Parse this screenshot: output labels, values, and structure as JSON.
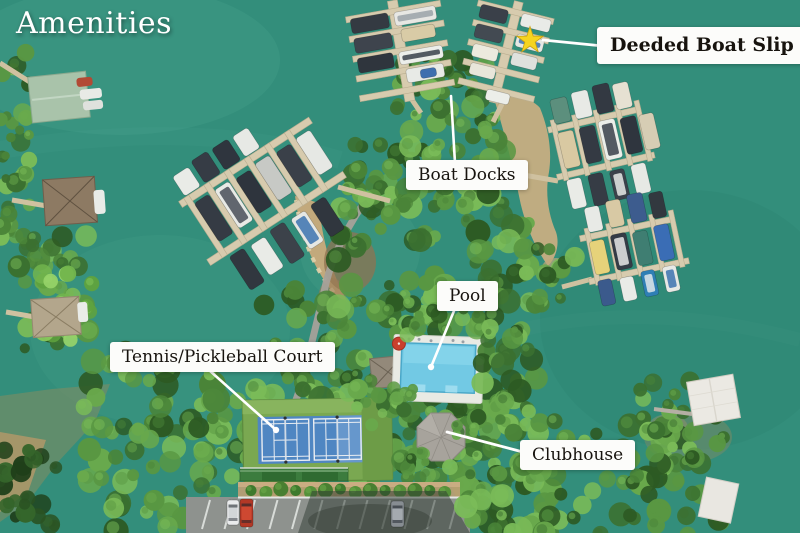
{
  "title": "Amenities",
  "labels": {
    "deeded_boat_slip": "Deeded Boat Slip",
    "boat_docks": "Boat Docks",
    "pool": "Pool",
    "tennis_pickleball": "Tennis/Pickleball Court",
    "clubhouse": "Clubhouse"
  },
  "marker": {
    "type": "star",
    "color": "#f6d41f"
  },
  "colors": {
    "water": "#338e7b",
    "label_bg": "#fcfcfa",
    "label_text": "#17130e",
    "title_text": "#ffffff",
    "leader_line": "#ffffff"
  }
}
